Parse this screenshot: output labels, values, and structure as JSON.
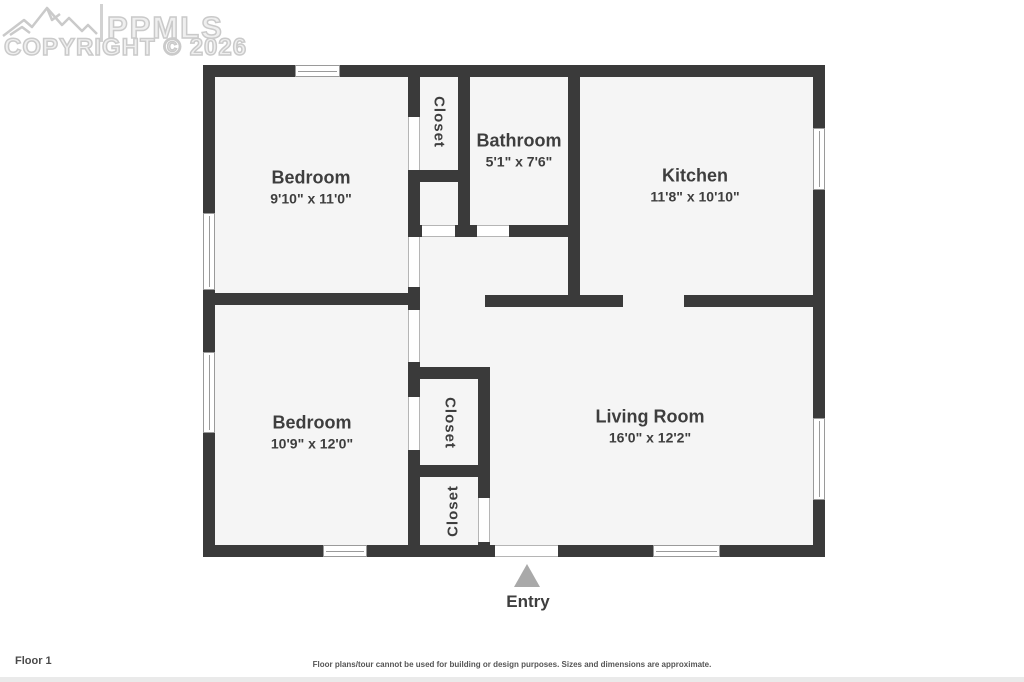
{
  "watermark": {
    "brand": "PPMLS",
    "copyright": "COPYRIGHT © 2026"
  },
  "rooms": [
    {
      "id": "bedroom-1",
      "name": "Bedroom",
      "dims": "9'10\" x 11'0\""
    },
    {
      "id": "bathroom",
      "name": "Bathroom",
      "dims": "5'1\" x 7'6\""
    },
    {
      "id": "kitchen",
      "name": "Kitchen",
      "dims": "11'8\" x 10'10\""
    },
    {
      "id": "bedroom-2",
      "name": "Bedroom",
      "dims": "10'9\" x 12'0\""
    },
    {
      "id": "living-room",
      "name": "Living Room",
      "dims": "16'0\" x 12'2\""
    },
    {
      "id": "closet-top",
      "name": "Closet"
    },
    {
      "id": "closet-middle",
      "name": "Closet"
    },
    {
      "id": "closet-bottom",
      "name": "Closet"
    }
  ],
  "entry": {
    "label": "Entry"
  },
  "footer": {
    "floor_label": "Floor 1",
    "disclaimer": "Floor plans/tour cannot be used for building or design purposes. Sizes and dimensions are approximate."
  },
  "colors": {
    "wall": "#3a3a3a",
    "floor": "#f5f5f5",
    "label_text": "#3e3e3e",
    "watermark": "#cacaca",
    "entry_arrow": "#a9a9a9"
  }
}
